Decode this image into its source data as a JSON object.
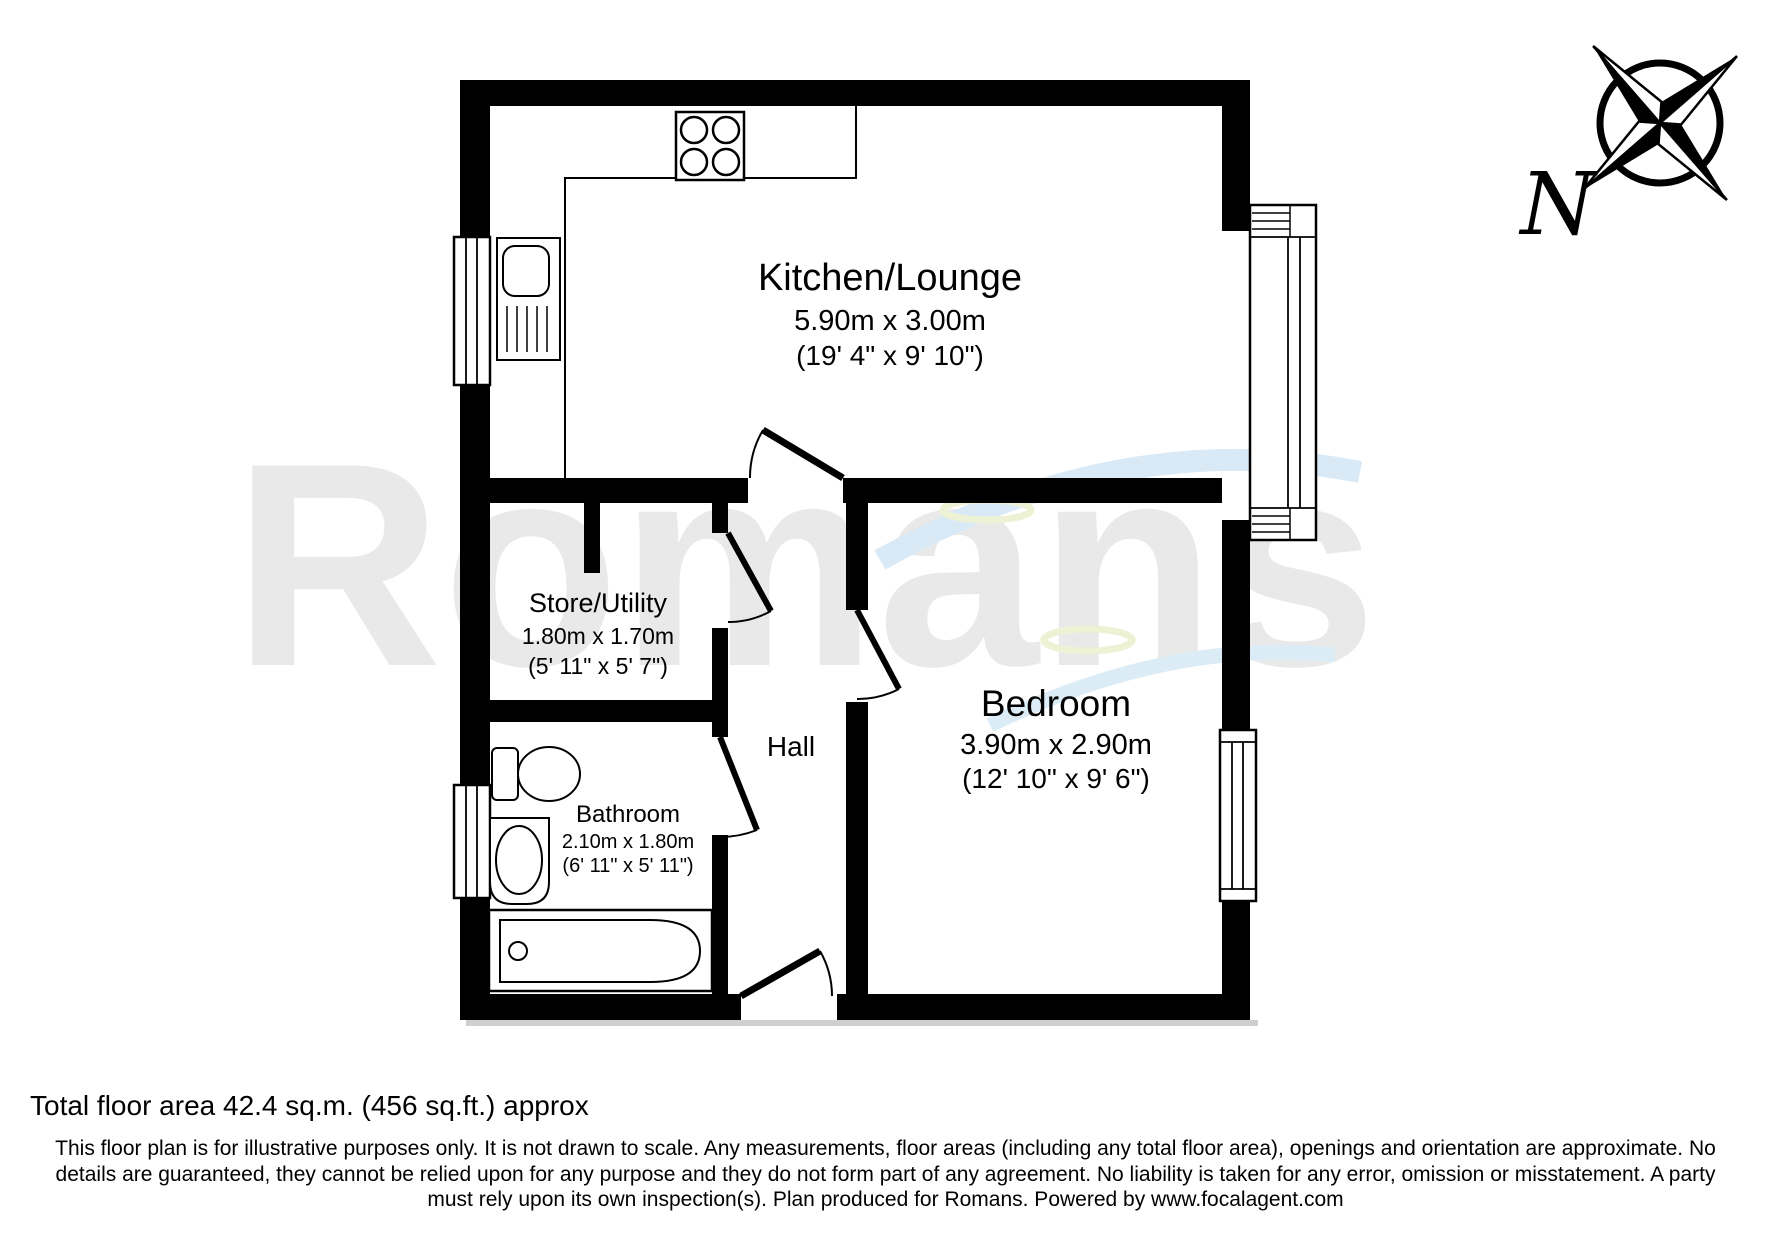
{
  "floorplan": {
    "watermark": "Romans",
    "compass": {
      "label": "N"
    },
    "rooms": [
      {
        "id": "kitchen-lounge",
        "name": "Kitchen/Lounge",
        "metric": "5.90m x 3.00m",
        "imperial": "(19' 4\" x 9' 10\")"
      },
      {
        "id": "store-utility",
        "name": "Store/Utility",
        "metric": "1.80m x 1.70m",
        "imperial": "(5' 11\" x 5' 7\")"
      },
      {
        "id": "hall",
        "name": "Hall",
        "metric": "",
        "imperial": ""
      },
      {
        "id": "bathroom",
        "name": "Bathroom",
        "metric": "2.10m x 1.80m",
        "imperial": "(6' 11\" x 5' 11\")"
      },
      {
        "id": "bedroom",
        "name": "Bedroom",
        "metric": "3.90m x 2.90m",
        "imperial": "(12' 10\" x 9' 6\")"
      }
    ]
  },
  "footer": {
    "total_area": "Total floor area 42.4 sq.m. (456 sq.ft.) approx",
    "disclaimer": [
      "This floor plan is for illustrative purposes only. It is not drawn to scale. Any measurements, floor areas (including any total floor area), openings and orientation are approximate. No",
      "details are guaranteed, they cannot be relied upon for any purpose and they do not form part of any agreement. No liability is taken for any error, omission or misstatement. A party",
      "must rely upon its own inspection(s). Plan produced for Romans. Powered by www.focalagent.com"
    ]
  },
  "colors": {
    "wall": "#000000",
    "watermark_gray": "#e9e9e9",
    "swoosh_blue": "#d9e9f5",
    "swoosh_pale": "#eef2d4",
    "background": "#ffffff"
  }
}
